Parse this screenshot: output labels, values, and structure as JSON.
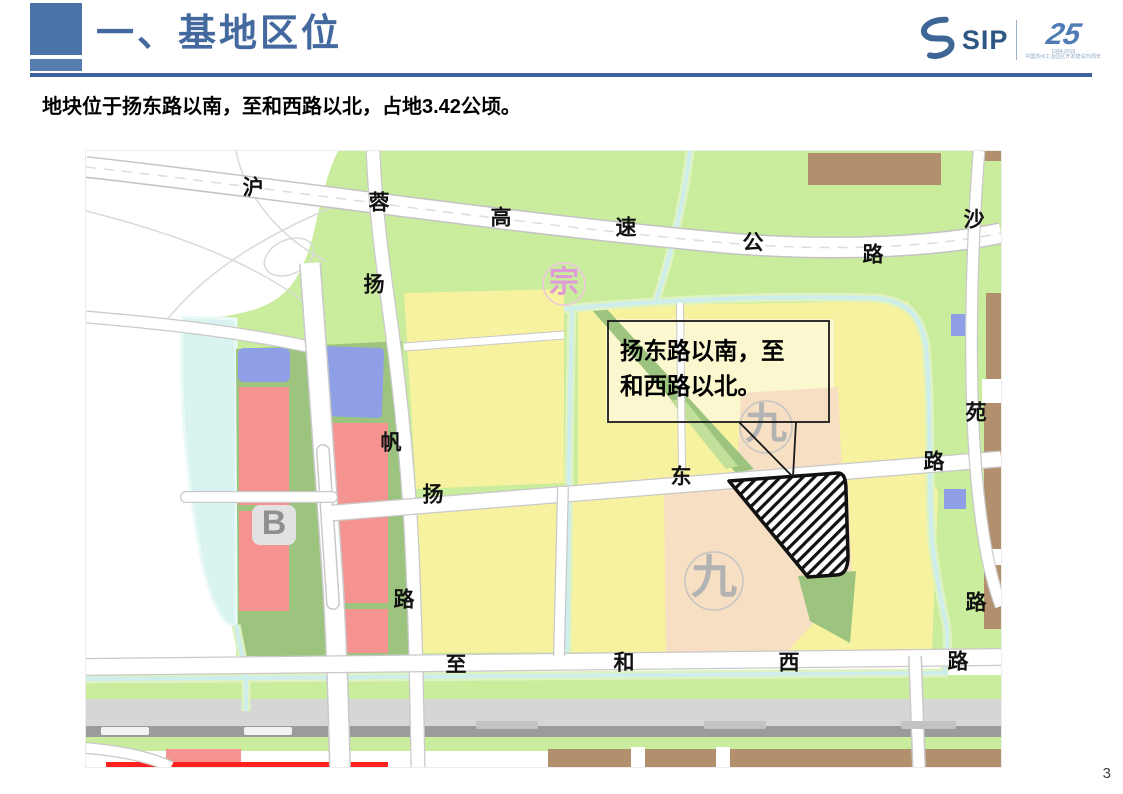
{
  "slide": {
    "title": "一、基地区位",
    "subtitle": "地块位于扬东路以南，至和西路以北，占地3.42公顷。",
    "page_number": "3"
  },
  "logo": {
    "sip_text": "SIP",
    "anniversary_number": "25",
    "fine_print_line1": "1994-2019",
    "fine_print_line2": "中国苏州工业园区开发建设25周年"
  },
  "map": {
    "callout": {
      "line1": "扬东路以南，至",
      "line2": "和西路以北。"
    },
    "labels": [
      {
        "t": "沪",
        "x": 167,
        "y": 38
      },
      {
        "t": "蓉",
        "x": 293,
        "y": 53
      },
      {
        "t": "高",
        "x": 415,
        "y": 68
      },
      {
        "t": "速",
        "x": 540,
        "y": 78
      },
      {
        "t": "公",
        "x": 667,
        "y": 93
      },
      {
        "t": "路",
        "x": 787,
        "y": 105
      },
      {
        "t": "沙",
        "x": 888,
        "y": 70
      },
      {
        "t": "扬",
        "x": 288,
        "y": 135
      },
      {
        "t": "帆",
        "x": 305,
        "y": 293
      },
      {
        "t": "路",
        "x": 318,
        "y": 450
      },
      {
        "t": "扬",
        "x": 347,
        "y": 345
      },
      {
        "t": "东",
        "x": 595,
        "y": 327
      },
      {
        "t": "路",
        "x": 848,
        "y": 312
      },
      {
        "t": "至",
        "x": 370,
        "y": 515
      },
      {
        "t": "和",
        "x": 538,
        "y": 513
      },
      {
        "t": "西",
        "x": 703,
        "y": 513
      },
      {
        "t": "路",
        "x": 872,
        "y": 512
      },
      {
        "t": "苑",
        "x": 890,
        "y": 263
      },
      {
        "t": "路",
        "x": 890,
        "y": 453
      }
    ],
    "watermarks": [
      {
        "t": "宗",
        "x": 478,
        "y": 133,
        "size": 30,
        "color": "#e09ad6",
        "ring": "#eec6e4",
        "r": 21,
        "bg": ""
      },
      {
        "t": "九",
        "x": 680,
        "y": 276,
        "size": 42,
        "color": "#b3b3b3",
        "ring": "#c4c4c4",
        "r": 26,
        "bg": ""
      },
      {
        "t": "九",
        "x": 628,
        "y": 430,
        "size": 46,
        "color": "#b3b3b3",
        "ring": "#c4c4c4",
        "r": 29,
        "bg": ""
      },
      {
        "t": "B",
        "x": 188,
        "y": 374,
        "size": 34,
        "color": "#8f8f8f",
        "ring": "",
        "r": 0,
        "bg": "#e2e2e2"
      }
    ],
    "colors": {
      "accent_blue": "#4a74a8",
      "park_green": "#c9ec9d",
      "verge_green": "#9cc47e",
      "parcel_yellow": "#f7f2a0",
      "parcel_pale_yellow": "#fbf8d0",
      "parcel_peach": "#f6dfc2",
      "parcel_salmon": "#f59390",
      "parcel_blue": "#8f9fe5",
      "parcel_brown": "#b28f6d",
      "water_cyan": "#d8f3f0",
      "transit_gray": "#d6d6d6",
      "highlight_red": "#ff2020",
      "site_hatch": "#111111"
    }
  }
}
